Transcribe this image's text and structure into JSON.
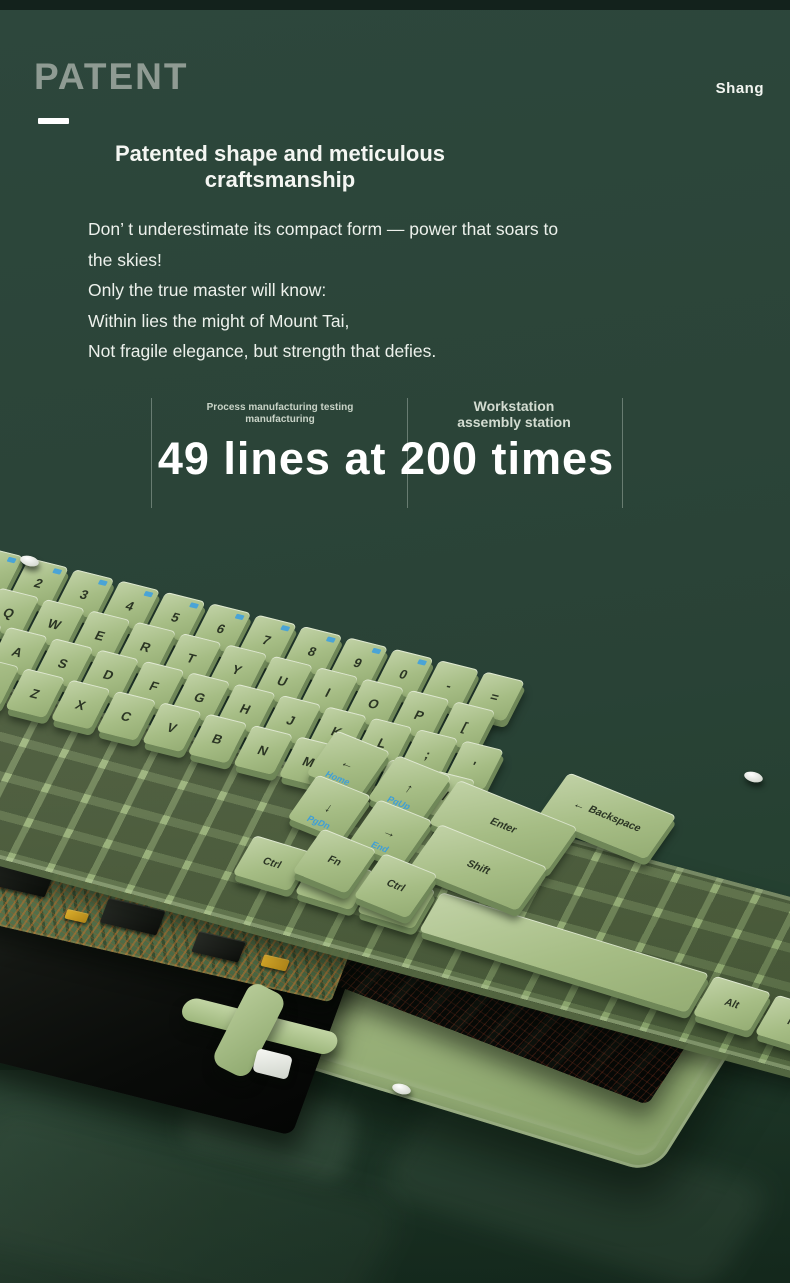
{
  "theme": {
    "background": "#2b4438",
    "top_strip": "#13221c",
    "text_white": "#f2f5f0",
    "patent_gray": "#8f9b93",
    "legend_blue": "#45a2da",
    "keycap_green": "#a6bd85",
    "frame_green": "#9ab37c",
    "pcb_green": "#577450",
    "pcb_trace_copper": "#b4702f",
    "tray_green": "#9cb37d",
    "plate_black": "#0c0e0b"
  },
  "header": {
    "title": "PATENT",
    "brand": "Shang"
  },
  "headline": {
    "line1": "Patented shape and meticulous",
    "line2": "craftsmanship"
  },
  "body": {
    "lines": [
      "Don’ t underestimate its compact form — power that soars to",
      "the skies!",
      "Only the true master will know:",
      "Within lies the might of Mount Tai,",
      "Not fragile elegance, but strength that defies."
    ]
  },
  "stats": {
    "col1": {
      "line1": "Process manufacturing testing",
      "line2": "manufacturing"
    },
    "col2": {
      "line1": "Workstation",
      "line2": "assembly station"
    },
    "headline": "49 lines at 200 times"
  },
  "keyboard": {
    "alt_text": "Exploded 3D view of a compact green keyboard: keycaps, frame plate, PCB with copper traces, black membrane sheet, black base plate, folding kickstand and bottom tray on a glossy dark-green desk",
    "main_rows": [
      {
        "keys": [
          {
            "l": "Esc",
            "b": 1
          },
          {
            "l": "1",
            "b": 1
          },
          {
            "l": "2",
            "b": 1
          },
          {
            "l": "3",
            "b": 1
          },
          {
            "l": "4",
            "b": 1
          },
          {
            "l": "5",
            "b": 1
          },
          {
            "l": "6",
            "b": 1
          },
          {
            "l": "7",
            "b": 1
          },
          {
            "l": "8",
            "b": 1
          },
          {
            "l": "9",
            "b": 1
          },
          {
            "l": "0",
            "b": 1
          },
          {
            "l": "-"
          },
          {
            "l": "="
          }
        ]
      },
      {
        "keys": [
          {
            "l": "Tab",
            "w": 1.5
          },
          {
            "l": "Q"
          },
          {
            "l": "W"
          },
          {
            "l": "E"
          },
          {
            "l": "R"
          },
          {
            "l": "T"
          },
          {
            "l": "Y"
          },
          {
            "l": "U"
          },
          {
            "l": "I"
          },
          {
            "l": "O"
          },
          {
            "l": "P"
          },
          {
            "l": "["
          }
        ]
      },
      {
        "keys": [
          {
            "l": "Caps",
            "w": 1.8
          },
          {
            "l": "A"
          },
          {
            "l": "S"
          },
          {
            "l": "D"
          },
          {
            "l": "F"
          },
          {
            "l": "G"
          },
          {
            "l": "H"
          },
          {
            "l": "J"
          },
          {
            "l": "K"
          },
          {
            "l": "L"
          },
          {
            "l": ";"
          },
          {
            "l": "'"
          }
        ]
      },
      {
        "keys": [
          {
            "l": "Shift",
            "w": 2.3
          },
          {
            "l": "Z"
          },
          {
            "l": "X"
          },
          {
            "l": "C"
          },
          {
            "l": "V"
          },
          {
            "l": "B"
          },
          {
            "l": "N"
          },
          {
            "l": "M"
          },
          {
            "l": ","
          },
          {
            "l": "."
          },
          {
            "l": "/"
          }
        ]
      }
    ],
    "bottom_row": [
      {
        "keys": [
          {
            "l": "Ctrl",
            "w": 1.25
          },
          {
            "l": "Alt",
            "w": 1.25
          },
          {
            "l": "Win",
            "w": 1.25
          },
          {
            "l": "",
            "w": 5.5
          },
          {
            "l": "Alt",
            "w": 1.25
          },
          {
            "l": "Fn",
            "w": 1.25
          }
        ]
      }
    ],
    "cluster_rows": [
      {
        "keys": [
          {
            "l": "Backspace",
            "w": 1.9,
            "dir": 1
          }
        ]
      },
      {
        "keys": [
          {
            "l": "←",
            "sub": "Home"
          },
          {
            "l": "↑",
            "sub": "PgUp"
          },
          {
            "l": "Enter",
            "w": 2.1
          }
        ]
      },
      {
        "keys": [
          {
            "l": "↓",
            "sub": "PgDn"
          },
          {
            "l": "→",
            "sub": "End"
          },
          {
            "l": "Shift",
            "w": 1.9
          }
        ]
      },
      {
        "keys": [
          {
            "l": "Fn"
          },
          {
            "l": "Ctrl"
          }
        ]
      }
    ],
    "screws": [
      {
        "x": 20,
        "y": 46
      },
      {
        "x": 744,
        "y": 262
      },
      {
        "x": 392,
        "y": 574
      }
    ]
  }
}
